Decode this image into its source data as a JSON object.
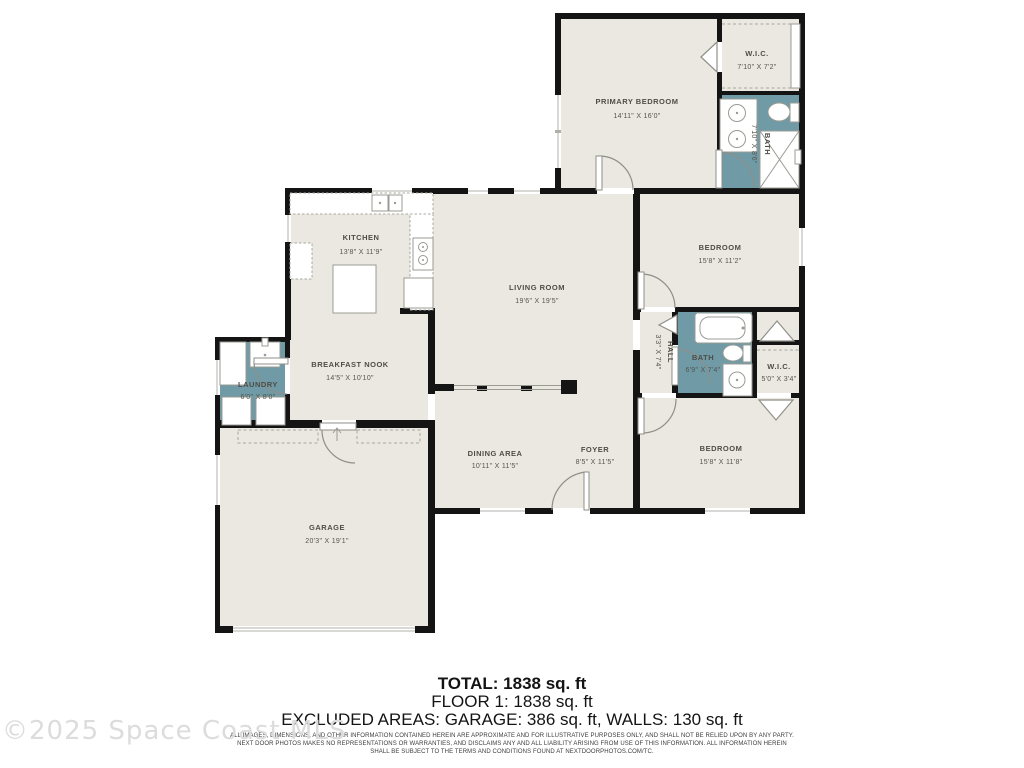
{
  "watermark": "©2025 Space Coast MLS",
  "colors": {
    "wall": "#141414",
    "room_fill": "#eae8e0",
    "wet_room_fill": "#6f9aa6",
    "label_text": "#4e4d47",
    "watermark_text": "#dcdcdc"
  },
  "rooms": {
    "primary_bedroom": {
      "name": "PRIMARY BEDROOM",
      "dims": "14'11\" X 16'0\""
    },
    "wic1": {
      "name": "W.I.C.",
      "dims": "7'10\" X 7'2\""
    },
    "bath1": {
      "name": "BATH",
      "dims": "7'10\" X 8'6\""
    },
    "kitchen": {
      "name": "KITCHEN",
      "dims": "13'8\" X 11'9\""
    },
    "living_room": {
      "name": "LIVING ROOM",
      "dims": "19'6\" X 19'5\""
    },
    "bedroom1": {
      "name": "BEDROOM",
      "dims": "15'8\" X 11'2\""
    },
    "hall": {
      "name": "HALL",
      "dims": "3'3\" X 7'4\""
    },
    "bath2": {
      "name": "BATH",
      "dims": "6'9\" X 7'4\""
    },
    "wic2": {
      "name": "W.I.C.",
      "dims": "5'0\" X 3'4\""
    },
    "breakfast_nook": {
      "name": "BREAKFAST NOOK",
      "dims": "14'5\" X 10'10\""
    },
    "laundry": {
      "name": "LAUNDRY",
      "dims": "6'0\" X 8'0\""
    },
    "dining_area": {
      "name": "DINING AREA",
      "dims": "10'11\" X 11'5\""
    },
    "foyer": {
      "name": "FOYER",
      "dims": "8'5\" X 11'5\""
    },
    "bedroom2": {
      "name": "BEDROOM",
      "dims": "15'8\" X 11'8\""
    },
    "garage": {
      "name": "GARAGE",
      "dims": "20'3\" X 19'1\""
    }
  },
  "footer": {
    "total": "TOTAL: 1838 sq. ft",
    "floor": "FLOOR 1: 1838 sq. ft",
    "excluded": "EXCLUDED AREAS: GARAGE: 386 sq. ft, WALLS: 130 sq. ft",
    "disclaimer_line1": "ALL IMAGES, DIMENSIONS, AND OTHER INFORMATION CONTAINED HEREIN ARE APPROXIMATE AND FOR ILLUSTRATIVE PURPOSES ONLY, AND SHALL NOT BE RELIED UPON BY ANY PARTY.",
    "disclaimer_line2": "NEXT DOOR PHOTOS MAKES NO REPRESENTATIONS OR WARRANTIES, AND DISCLAIMS ANY AND ALL LIABILITY ARISING FROM USE OF THIS INFORMATION. ALL INFORMATION HEREIN",
    "disclaimer_line3": "SHALL BE SUBJECT TO THE TERMS AND CONDITIONS FOUND AT NEXTDOORPHOTOS.COM/TC."
  }
}
